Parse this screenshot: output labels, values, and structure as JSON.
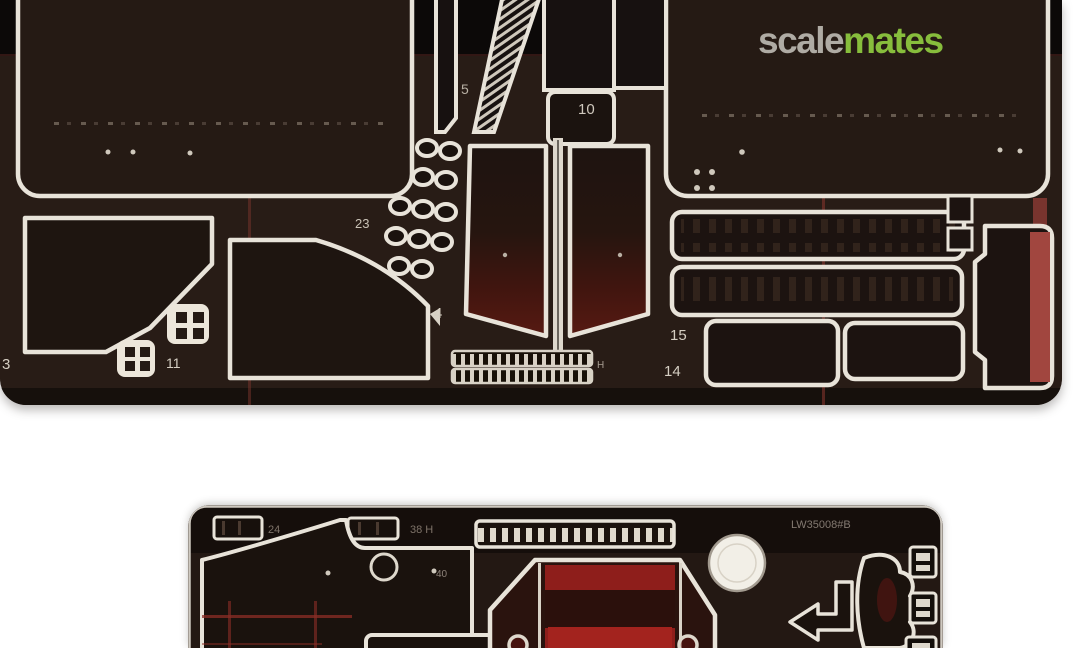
{
  "watermark": {
    "scale": "scale",
    "mates": "mates"
  },
  "colors": {
    "background": "#ffffff",
    "fret_body": "#281c16",
    "fret_top_band": "#0c0908",
    "etch_outline": "#e8e3d9",
    "red_backing": "#8e1e1b",
    "red_streak": "#7a332c",
    "logo_gray": "#b7b3ac",
    "logo_green": "#8dc63f"
  },
  "top_fret": {
    "labels": [
      {
        "id": "part-5",
        "text": "5"
      },
      {
        "id": "part-10",
        "text": "10"
      },
      {
        "id": "part-23",
        "text": "23"
      },
      {
        "id": "part-4",
        "text": "4"
      },
      {
        "id": "part-3",
        "text": "3"
      },
      {
        "id": "part-11",
        "text": "11"
      },
      {
        "id": "part-15",
        "text": "15"
      },
      {
        "id": "part-14",
        "text": "14"
      },
      {
        "id": "strip-mark",
        "text": "H"
      }
    ]
  },
  "bottom_fret": {
    "labels": [
      {
        "id": "part-24",
        "text": "24"
      },
      {
        "id": "part-38",
        "text": "38 H"
      },
      {
        "id": "part-40",
        "text": "40"
      },
      {
        "id": "sheet-code",
        "text": "LW35008#B"
      }
    ]
  }
}
